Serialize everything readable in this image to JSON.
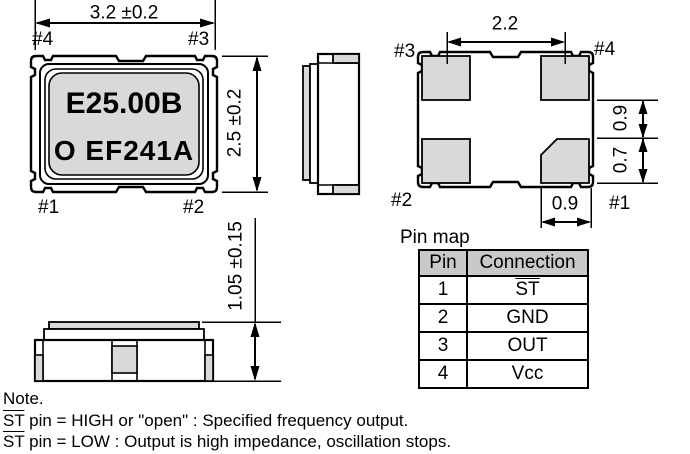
{
  "dims": {
    "top_width": "3.2 ±0.2",
    "top_height": "2.5 ±0.2",
    "pad_pitch": "2.2",
    "pad_gap": "0.9",
    "pad_len": "0.7",
    "pad_width": "0.9",
    "total_height": "1.05 ±0.15"
  },
  "marking": {
    "line1": "E25.00B",
    "line2": "O EF241A"
  },
  "pins_top_view": {
    "p4": "#4",
    "p3": "#3",
    "p1": "#1",
    "p2": "#2"
  },
  "pins_bottom_view": {
    "p3": "#3",
    "p4": "#4",
    "p2": "#2",
    "p1": "#1"
  },
  "pin_map": {
    "title": "Pin map",
    "headers": {
      "pin": "Pin",
      "connection": "Connection"
    },
    "rows": [
      {
        "pin": "1",
        "connection": "ST"
      },
      {
        "pin": "2",
        "connection": "GND"
      },
      {
        "pin": "3",
        "connection": "OUT"
      },
      {
        "pin": "4",
        "connection": "Vcc"
      }
    ]
  },
  "note": {
    "title": "Note.",
    "lines": [
      {
        "st": "ST",
        "text": " pin = HIGH or \"open\" : Specified frequency output."
      },
      {
        "st": "ST",
        "text": " pin = LOW : Output is high impedance, oscillation stops."
      }
    ]
  },
  "colors": {
    "line": "#000000",
    "gray_fill": "#d9d9d9",
    "table_header_bg": "#c9c9c9"
  }
}
